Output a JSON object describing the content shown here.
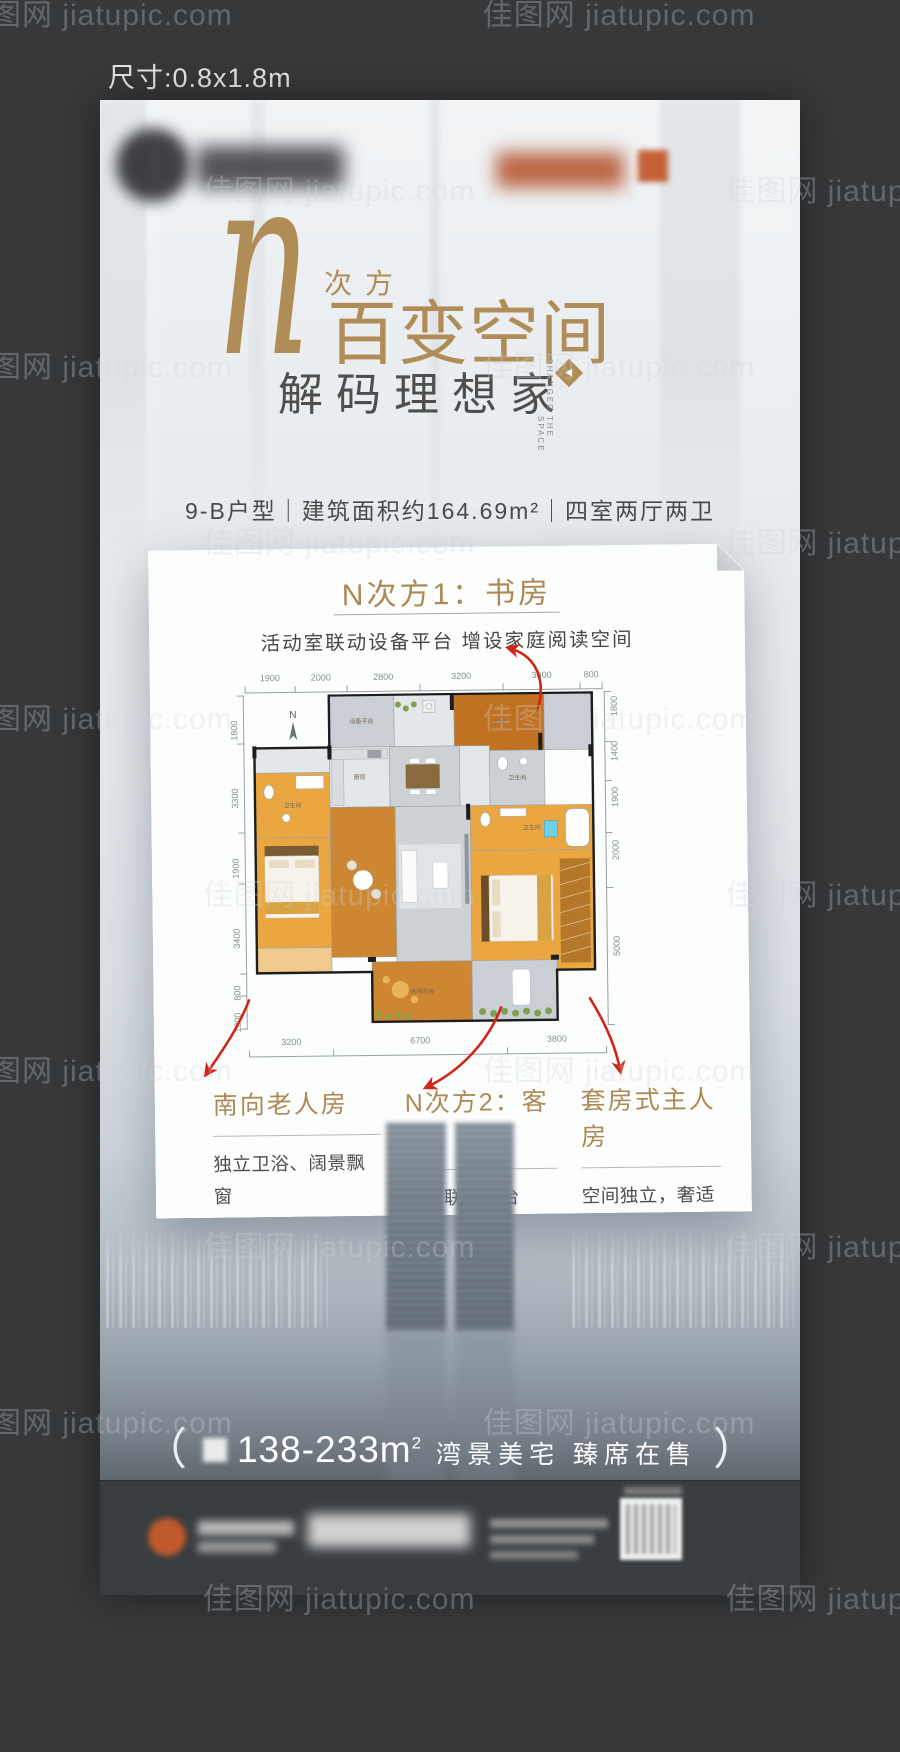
{
  "meta": {
    "size_label": "尺寸:0.8x1.8m",
    "watermark": "佳图网 jiatupic.com"
  },
  "colors": {
    "gold": "#b08c56",
    "arrow_red": "#cf2617",
    "text_dark": "#4a4a4a",
    "poster_light": "#e9edf0",
    "outer_bg": "#36383a",
    "footer_bg": "#3a3d40",
    "logo_orange": "#c05a2d",
    "plan": {
      "tile": "#e4e7ea",
      "gray": "#ccd1d6",
      "deck": "#c9cfd4",
      "orange": "#eaa741",
      "orangeL": "#f2c98c",
      "wood": "#cd8631",
      "wood2": "#c07122"
    }
  },
  "title": {
    "n": "n",
    "power": "次方",
    "main": "百变空间",
    "sub": "解码理想家",
    "en_1": "CHANGED",
    "en_2": "THE SPACE",
    "spec": "9-B户型｜建筑面积约164.69m²｜四室两厅两卫"
  },
  "card": {
    "feature_top": {
      "title": "N次方1：书房",
      "desc": "活动室联动设备平台 增设家庭阅读空间"
    },
    "floorplan": {
      "compass": "N",
      "dims_top": [
        1900,
        2000,
        2800,
        3200,
        3000,
        800
      ],
      "dims_bottom": [
        3200,
        6700,
        3800
      ],
      "dims_left": [
        1800,
        3300,
        1900,
        3400,
        800,
        1200
      ],
      "dims_right": [
        1800,
        1400,
        1900,
        2000,
        5000
      ],
      "rooms": [
        {
          "label": "设备平台",
          "x": 82,
          "y": 0,
          "w": 65,
          "h": 52,
          "t": "deck"
        },
        {
          "label": "",
          "x": 147,
          "y": 0,
          "w": 60,
          "h": 52,
          "t": "tile"
        },
        {
          "label": "书房",
          "x": 207,
          "y": 0,
          "w": 90,
          "h": 57,
          "t": "wood2"
        },
        {
          "label": "",
          "x": 297,
          "y": 0,
          "w": 48,
          "h": 57,
          "t": "deck"
        },
        {
          "label": "",
          "x": 7,
          "y": 52,
          "w": 75,
          "h": 25,
          "t": "tile"
        },
        {
          "label": "卫生间",
          "x": 7,
          "y": 77,
          "w": 75,
          "h": 65,
          "t": "orange"
        },
        {
          "label": "卧室",
          "x": 7,
          "y": 142,
          "w": 75,
          "h": 110,
          "t": "orange"
        },
        {
          "label": "",
          "x": 7,
          "y": 252,
          "w": 75,
          "h": 25,
          "t": "orangeL"
        },
        {
          "label": "厨房",
          "x": 82,
          "y": 52,
          "w": 60,
          "h": 60,
          "t": "tile"
        },
        {
          "label": "餐厅",
          "x": 142,
          "y": 52,
          "w": 70,
          "h": 60,
          "t": "gray"
        },
        {
          "label": "",
          "x": 212,
          "y": 52,
          "w": 30,
          "h": 60,
          "t": "tile"
        },
        {
          "label": "卫生间",
          "x": 242,
          "y": 57,
          "w": 55,
          "h": 55,
          "t": "gray"
        },
        {
          "label": "茶室",
          "x": 82,
          "y": 112,
          "w": 65,
          "h": 150,
          "t": "wood"
        },
        {
          "label": "客厅",
          "x": 147,
          "y": 112,
          "w": 75,
          "h": 155,
          "t": "gray"
        },
        {
          "label": "卫生间",
          "x": 222,
          "y": 112,
          "w": 123,
          "h": 45,
          "t": "orange"
        },
        {
          "label": "主卧",
          "x": 222,
          "y": 157,
          "w": 123,
          "h": 120,
          "t": "orange"
        },
        {
          "label": "休闲阳台",
          "x": 122,
          "y": 267,
          "w": 100,
          "h": 60,
          "t": "wood"
        },
        {
          "label": "",
          "x": 222,
          "y": 267,
          "w": 85,
          "h": 60,
          "t": "deck"
        }
      ]
    },
    "features": [
      {
        "title": "南向老人房",
        "lines": [
          "独立卫浴、阔景飘窗",
          "尊享老年生活"
        ]
      },
      {
        "title": "N次方2：客卧",
        "lines": [
          "茶室联动阳台",
          "朗阔客卧，礼遇来宾"
        ]
      },
      {
        "title": "套房式主人房",
        "lines": [
          "空间独立，奢适尺度",
          "壹号人物静谧与私密同享"
        ]
      }
    ]
  },
  "footer": {
    "slogan": {
      "open": "（",
      "range": "138-233m",
      "sup": "2",
      "tail": "湾景美宅 臻席在售",
      "close": "）"
    }
  }
}
